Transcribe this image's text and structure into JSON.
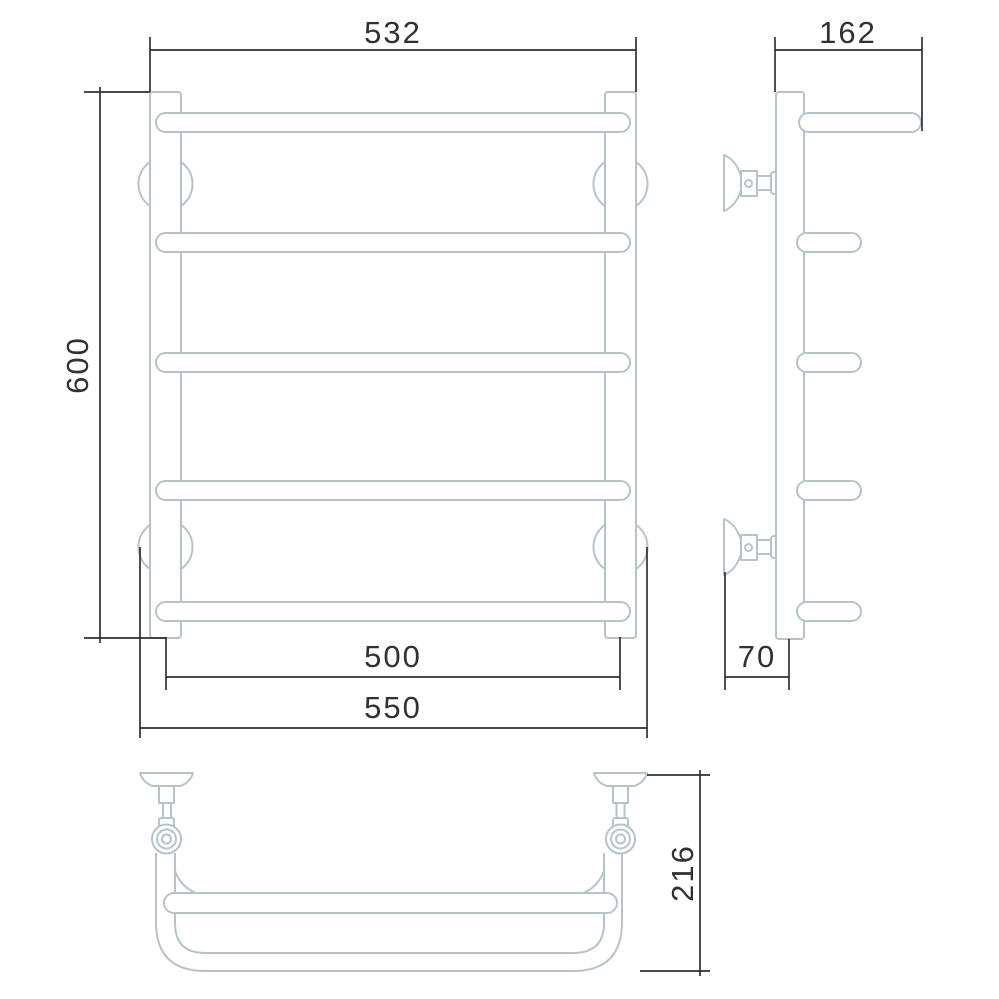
{
  "dimensions": {
    "front_top_width": "532",
    "front_height": "600",
    "front_axis_width": "500",
    "front_overall_width": "550",
    "side_top_rail_depth": "162",
    "side_wall_offset": "70",
    "top_view_depth": "216"
  },
  "colors": {
    "background": "#ffffff",
    "product_line": "#b6c3cb",
    "dimension_line": "#2e3135",
    "dimension_text": "#2e3135"
  }
}
